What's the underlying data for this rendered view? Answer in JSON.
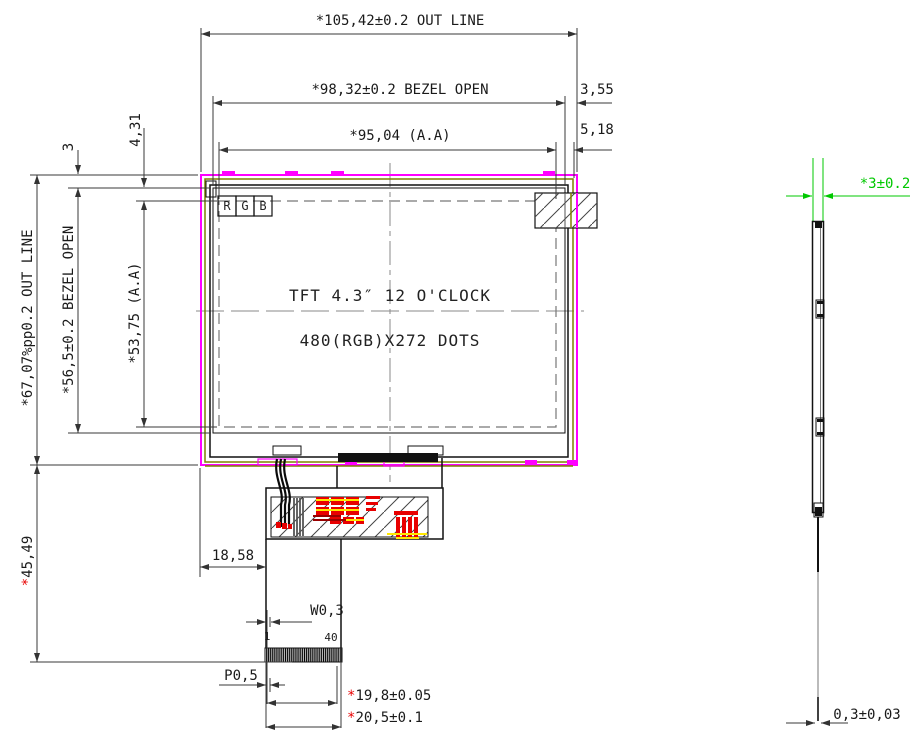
{
  "drawing": {
    "type": "TFT LCD module outline drawing",
    "panel_text": {
      "line1": "TFT 4.3″ 12 O'CLOCK",
      "line2": "480(RGB)X272 DOTS"
    },
    "rgb_marks": [
      "R",
      "G",
      "B"
    ]
  },
  "labels": {
    "out_line_w": "*105,42±0.2 OUT LINE",
    "bezel_open_w": "*98,32±0.2 BEZEL OPEN",
    "margin_right_bezel": "3,55",
    "aa_w": "*95,04 (A.A)",
    "margin_right_aa": "5,18",
    "out_line_h": "*67,07%pp0.2 OUT LINE",
    "margin_top_bezel": "3",
    "bezel_open_h": "*56,5±0.2 BEZEL OPEN",
    "margin_top_aa": "4,31",
    "aa_h": "*53,75 (A.A)",
    "fpc_length": {
      "star": "*",
      "value": "45,49"
    },
    "fpc_offset": "18,58",
    "pin_width": "W0,3",
    "pin_first": "1",
    "pin_last": "40",
    "pin_pitch": "P0,5",
    "conn_width_inner": {
      "star": "*",
      "value": "19,8±0.05"
    },
    "conn_width_outer": {
      "star": "*",
      "value": "20,5±0.1"
    },
    "thickness": "*3±0.2",
    "fpc_thickness": "0,3±0,03"
  },
  "colors": {
    "outline_magenta": "#FF00FF",
    "film_olive": "#7F7F00",
    "dim_green": "#00C800",
    "accent_red": "#E80000",
    "accent_yellow": "#FFE800"
  }
}
